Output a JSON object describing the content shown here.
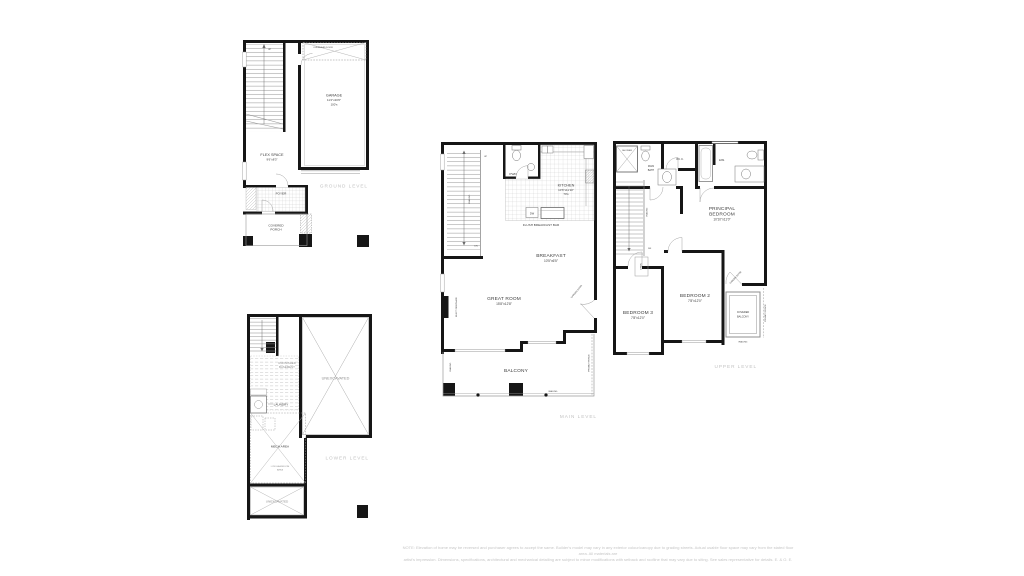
{
  "colors": {
    "background": "#ffffff",
    "wall": "#161616",
    "thin_line": "#9a9a9a",
    "room_label": "#3d3d3d",
    "muted_label": "#8f8f8f",
    "level_label": "#c2c2c2",
    "disclaimer": "#c6c6c6"
  },
  "disclaimer": {
    "line1": "NOTE: Elevation of home may be reversed and purchaser agrees to accept the same. Builder's model may vary in any exterior colour/canopy due to grading streets. Actual usable floor space may vary from the stated floor area. All materials are",
    "line2": "artist's impression. Dimensions, specifications, architectural and mechanical detailing are subject to minor modifications with setback and roofline that may vary due to siting. See sales representative for details. E. & O. E."
  },
  "ground": {
    "title": "GROUND LEVEL",
    "garage_name": "GARAGE",
    "garage_dims": "11'2\"x20'6\"",
    "garage_note": "100's",
    "overhead_door": "OVERHEAD DOOR",
    "flex_name": "FLEX SPACE",
    "flex_dims": "9'6\"x8'3\"",
    "foyer": "FOYER",
    "porch_line1": "COVERED",
    "porch_line2": "PORCH",
    "up": "UP"
  },
  "lower": {
    "title": "LOWER LEVEL",
    "unfinished_line1": "UNFINISHED",
    "unfinished_line2": "BASEMENT",
    "laundry": "LAUNDRY",
    "mech": "MECH AREA",
    "low_headroom_line1": "LOW HEADROOM",
    "low_headroom_line2": "AREA",
    "unexcavated_small": "UNEXCAVATED",
    "unexcavated_large": "UNEXCAVATED"
  },
  "main": {
    "title": "MAIN LEVEL",
    "pwd": "PWD",
    "kitchen_name": "KITCHEN",
    "kitchen_dims": "10'6\"x11'10\"",
    "kitchen_note": "70's",
    "dw": "DW",
    "flush_bar": "FLUSH BREAKFAST BAR",
    "breakfast_name": "BREAKFAST",
    "breakfast_dims": "10'5\"x6'5\"",
    "great_name": "GREAT ROOM",
    "great_dims": "15'8\"x12'8\"",
    "fireplace": "ELECT FIREPLACE",
    "garden_door": "GARDEN DOOR",
    "balcony": "BALCONY",
    "railing_stairs": "RAILING",
    "railing_left": "RAILING",
    "railing_bottom": "RAILING",
    "privacy_fence": "PRIVACY FENCE",
    "up": "UP",
    "dn": "DN"
  },
  "upper": {
    "title": "UPPER LEVEL",
    "shower": "SHOWER",
    "main_bath_line1": "MAIN",
    "main_bath_line2": "BATH",
    "wic": "W.I.C.",
    "ens": "ENS.",
    "principal_line1": "PRINCIPAL",
    "principal_line2": "BEDROOM",
    "principal_dims": "10'10\"x11'0\"",
    "dn": "DN",
    "railing": "RAILING",
    "linen": "LINEN",
    "bed3_name": "BEDROOM 3",
    "bed3_dims": "7'8\"x12'0\"",
    "bed2_name": "BEDROOM 2",
    "bed2_dims": "7'8\"x12'0\"",
    "garden_door": "GARDEN DOOR",
    "balcony_line1": "COVERED",
    "balcony_line2": "BALCONY",
    "railing2": "RAILING",
    "privacy_fence": "PRIVACY FENCE"
  }
}
